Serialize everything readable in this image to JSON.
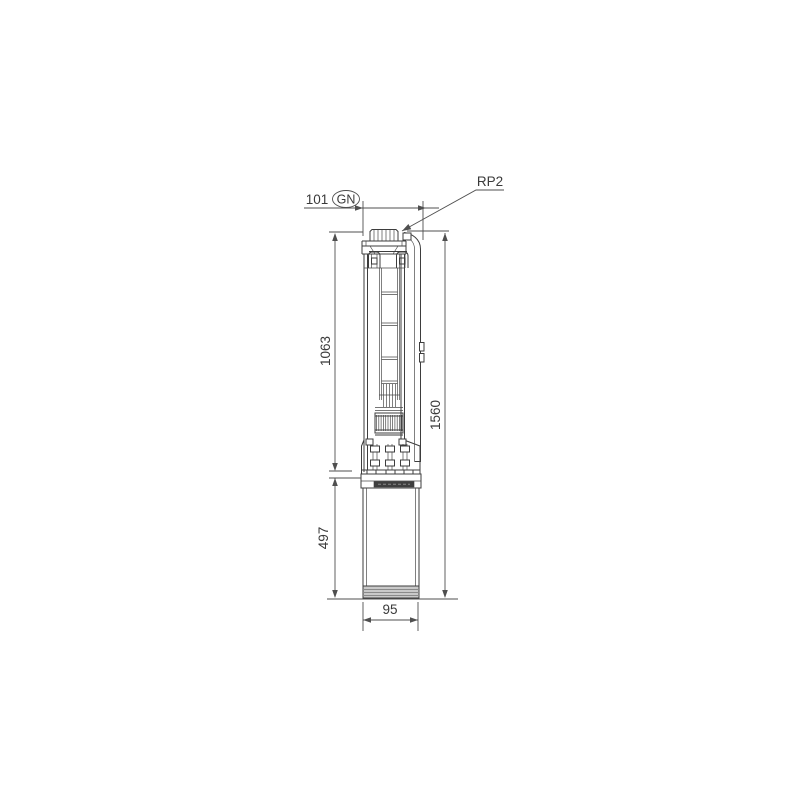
{
  "page": {
    "background": "#ffffff"
  },
  "drawing": {
    "type": "technical-dimension-drawing",
    "subject": "submersible borehole pump, side elevation with dimensions",
    "labels": {
      "thread_connection": "RP2",
      "gland": "GN",
      "top_width_mm": "101",
      "pump_section_length_mm": "1063",
      "motor_length_mm": "497",
      "total_length_mm": "1560",
      "motor_diameter_mm": "95"
    },
    "colors": {
      "line": "#3d3d3d",
      "dimension": "#4f4f4f",
      "text": "#3a3a3a",
      "motor_band": "#c9c9c9",
      "cable_plug_strip": "#3f3f3f"
    }
  }
}
